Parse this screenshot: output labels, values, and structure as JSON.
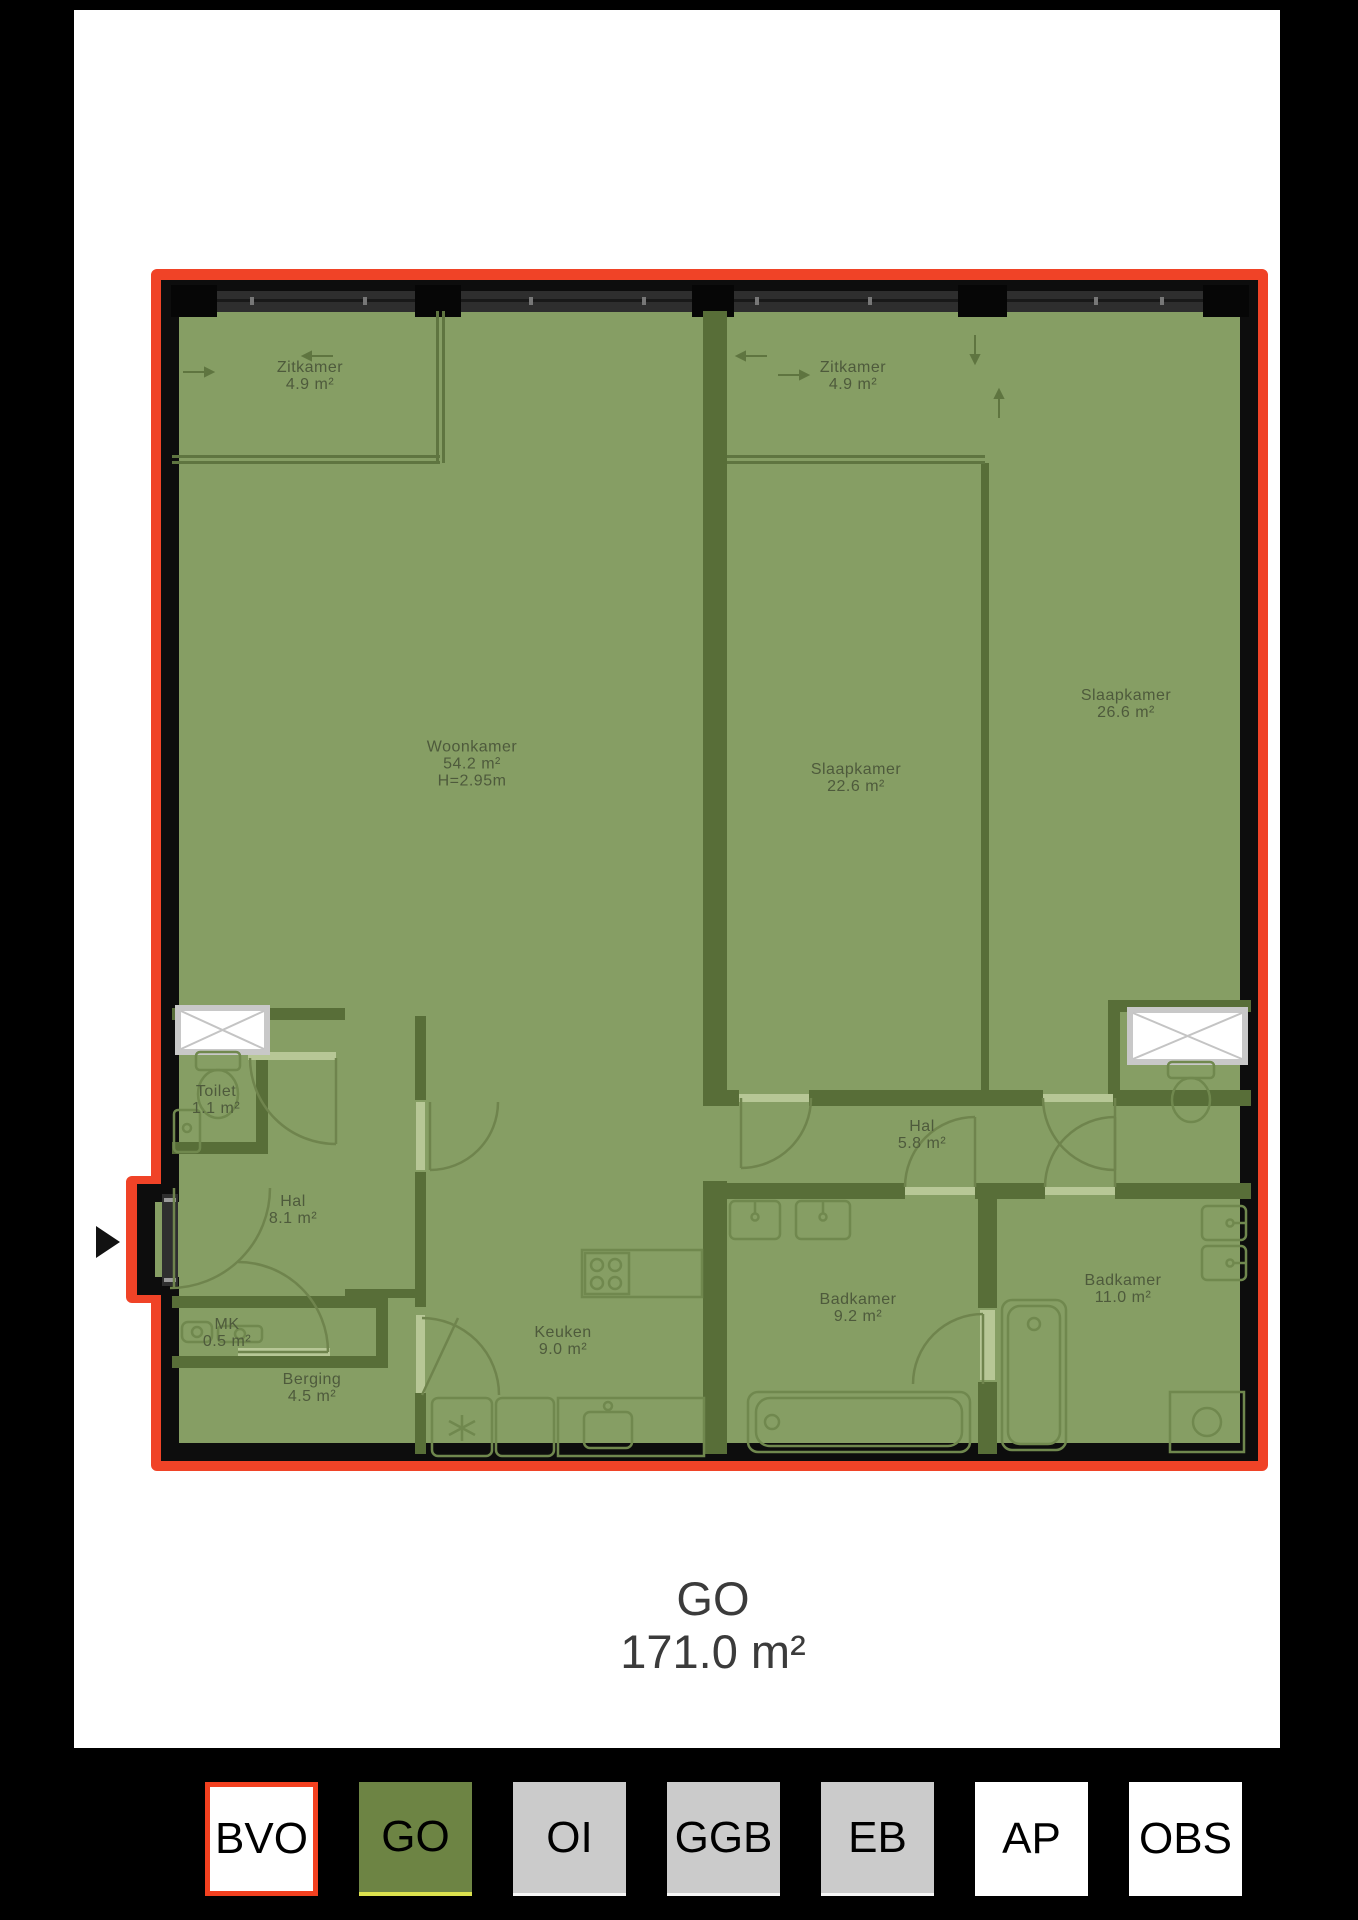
{
  "plan": {
    "caption": {
      "label": "GO",
      "area": "171.0 m²"
    },
    "rooms": [
      {
        "id": "zitkamer-left",
        "name": "Zitkamer",
        "area": "4.9 m²"
      },
      {
        "id": "zitkamer-right",
        "name": "Zitkamer",
        "area": "4.9 m²"
      },
      {
        "id": "woonkamer",
        "name": "Woonkamer",
        "area": "54.2 m²",
        "height_note": "H=2.95m"
      },
      {
        "id": "slaapkamer-1",
        "name": "Slaapkamer",
        "area": "22.6 m²"
      },
      {
        "id": "slaapkamer-2",
        "name": "Slaapkamer",
        "area": "26.6 m²"
      },
      {
        "id": "toilet",
        "name": "Toilet",
        "area": "1.1 m²"
      },
      {
        "id": "hal-1",
        "name": "Hal",
        "area": "8.1 m²"
      },
      {
        "id": "mk",
        "name": "MK",
        "area": "0.5 m²"
      },
      {
        "id": "berging",
        "name": "Berging",
        "area": "4.5 m²"
      },
      {
        "id": "keuken",
        "name": "Keuken",
        "area": "9.0 m²"
      },
      {
        "id": "hal-2",
        "name": "Hal",
        "area": "5.8 m²"
      },
      {
        "id": "badkamer-1",
        "name": "Badkamer",
        "area": "9.2 m²"
      },
      {
        "id": "badkamer-2",
        "name": "Badkamer",
        "area": "11.0 m²"
      }
    ],
    "colors": {
      "overlay_green": "#869E64",
      "wall_olive": "#586E38",
      "outline_red": "#F04327",
      "outer_wall_black": "#0D0D0D",
      "label_text": "#4E5A3C",
      "caption_text": "#3B3B3B"
    }
  },
  "legend": {
    "buttons": [
      {
        "label": "BVO",
        "bg": "#FFFFFF",
        "border": "#F3401F",
        "selected": false
      },
      {
        "label": "GO",
        "bg": "#6D8444",
        "underline": "#DCE24E",
        "selected": true
      },
      {
        "label": "OI",
        "bg": "#CBCBCB",
        "selected": false
      },
      {
        "label": "GGB",
        "bg": "#CBCBCB",
        "selected": false
      },
      {
        "label": "EB",
        "bg": "#CBCBCB",
        "selected": false
      },
      {
        "label": "AP",
        "bg": "#FFFFFF",
        "selected": false
      },
      {
        "label": "OBS",
        "bg": "#FFFFFF",
        "selected": false
      }
    ]
  }
}
